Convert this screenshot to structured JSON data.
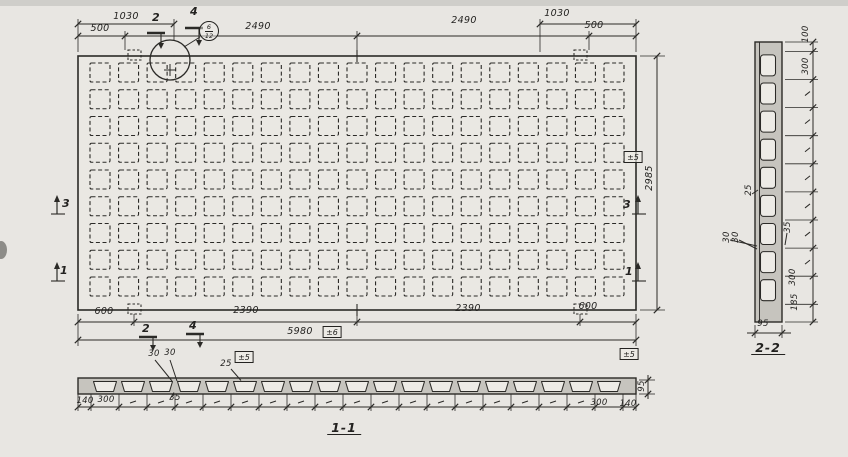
{
  "colors": {
    "ink": "#2b2a27",
    "paper": "#e8e6e2",
    "planfill": "#eae8e3",
    "slab": "#c6c4be",
    "void": "#edebe6"
  },
  "plan": {
    "grid": {
      "rows": 9,
      "cols": 19
    },
    "dims": {
      "top_1030_left": "1030",
      "top_500_left": "500",
      "top_2490_left": "2490",
      "top_2490_right": "2490",
      "top_1030_right": "1030",
      "top_500_right": "500",
      "bottom_600_left": "600",
      "bottom_2390_left": "2390",
      "bottom_2390_right": "2390",
      "bottom_600_right": "600",
      "bottom_total": "5980",
      "bottom_total_tol": "±6",
      "right_height": "2985",
      "right_height_tol": "±5"
    },
    "cut_marks": {
      "c2": "2",
      "c4": "4",
      "c3": "3",
      "c1": "1"
    },
    "detail_bubble": {
      "detail_no": "6",
      "sheet_no": "12"
    }
  },
  "section11": {
    "title": "1-1",
    "voids": 19,
    "labels": {
      "rib_top_a": "30",
      "rib_top_b": "30",
      "flange": "25",
      "flange_tol": "±5",
      "rib_bottom": "35",
      "height": "95",
      "height_tol": "±5",
      "edge_left": "140",
      "pitch_left": "300",
      "pitch_right": "300",
      "edge_right": "140"
    }
  },
  "section22": {
    "title": "2-2",
    "voids": 9,
    "labels": {
      "end_top": "100",
      "pitch_top": "300",
      "pitch_bottom": "300",
      "end_bottom": "185",
      "depth": "95",
      "flange": "25",
      "rib_a": "30",
      "rib_b": "30",
      "rib": "35"
    }
  }
}
